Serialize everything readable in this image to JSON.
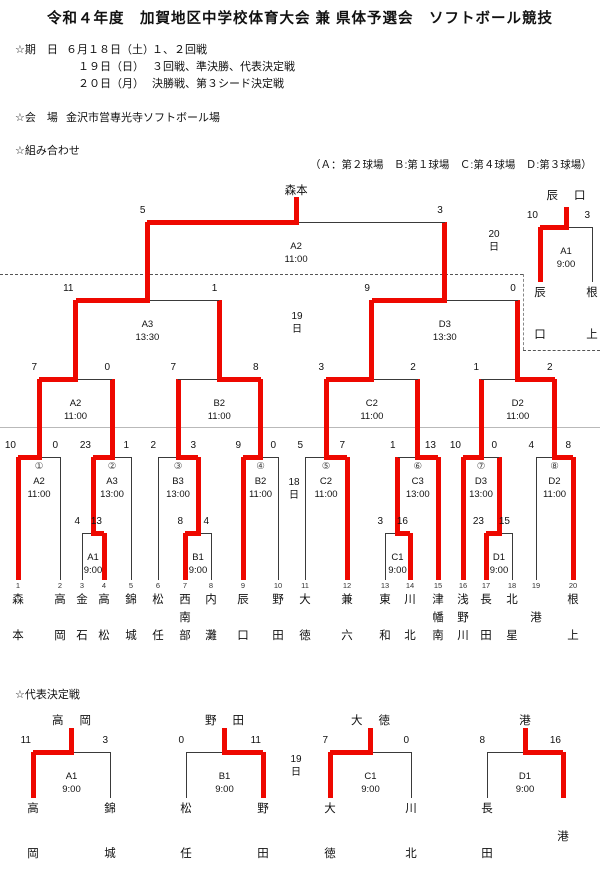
{
  "colors": {
    "winner_path": "#ee0800",
    "line": "#3a3a3a"
  },
  "header": {
    "title": "令和４年度　加賀地区中学校体育大会 兼 県体予選会　ソフトボール競技",
    "date_label": "☆期　日",
    "schedule": [
      {
        "date": "６月１８日（土）",
        "games": "１、２回戦"
      },
      {
        "date": "１９日（日）",
        "games": "３回戦、準決勝、代表決定戦"
      },
      {
        "date": "２０日（月）",
        "games": "決勝戦、第３シード決定戦"
      }
    ],
    "venue_label": "☆会　場",
    "venue": "金沢市営専光寺ソフトボール場",
    "pairings_label": "☆組み合わせ",
    "fields_note": "（Ａ：第２球場　Ｂ:第１球場　Ｃ:第４球場　Ｄ:第３球場）"
  },
  "rep_heading": "☆代表決定戦",
  "champion": "森本",
  "day_labels": [
    {
      "text": "20\n日",
      "x": 494,
      "y": 228
    },
    {
      "text": "19\n日",
      "x": 297,
      "y": 310
    },
    {
      "text": "18\n日",
      "x": 294,
      "y": 476
    },
    {
      "text": "19\n日",
      "x": 296,
      "y": 753
    }
  ],
  "teams": [
    {
      "seed": "1",
      "name": "森本",
      "x": 18
    },
    {
      "seed": "2",
      "name": "高岡",
      "x": 60
    },
    {
      "seed": "3",
      "name": "金石",
      "x": 82
    },
    {
      "seed": "4",
      "name": "高松",
      "x": 104
    },
    {
      "seed": "5",
      "name": "錦城",
      "x": 131
    },
    {
      "seed": "6",
      "name": "松任",
      "x": 158
    },
    {
      "seed": "7",
      "name": "西南部",
      "x": 185
    },
    {
      "seed": "8",
      "name": "内灘",
      "x": 211
    },
    {
      "seed": "9",
      "name": "辰口",
      "x": 243
    },
    {
      "seed": "10",
      "name": "野田",
      "x": 278
    },
    {
      "seed": "11",
      "name": "大徳",
      "x": 305
    },
    {
      "seed": "12",
      "name": "兼六",
      "x": 347
    },
    {
      "seed": "13",
      "name": "東和",
      "x": 385
    },
    {
      "seed": "14",
      "name": "川北",
      "x": 410
    },
    {
      "seed": "15",
      "name": "津幡南",
      "x": 438
    },
    {
      "seed": "16",
      "name": "浅野川",
      "x": 463
    },
    {
      "seed": "17",
      "name": "長田",
      "x": 486
    },
    {
      "seed": "18",
      "name": "北星",
      "x": 512
    },
    {
      "seed": "19",
      "name": "港",
      "x": 536
    },
    {
      "seed": "20",
      "name": "根上",
      "x": 573
    }
  ],
  "matches": [
    {
      "id": "r1-A1",
      "code": "A1",
      "time": "9:00",
      "bar_y": 533,
      "up_y": 457,
      "lx": 82,
      "rx": 104,
      "ls": "4",
      "rs": "13",
      "win": "R",
      "ld": 580,
      "rd": 580,
      "lred": false,
      "rred": true
    },
    {
      "id": "r1-B1",
      "code": "B1",
      "time": "9:00",
      "bar_y": 533,
      "up_y": 457,
      "lx": 185,
      "rx": 211,
      "ls": "8",
      "rs": "4",
      "win": "L",
      "ld": 580,
      "rd": 580,
      "lred": true,
      "rred": false
    },
    {
      "id": "r1-C1",
      "code": "C1",
      "time": "9:00",
      "bar_y": 533,
      "up_y": 457,
      "lx": 385,
      "rx": 410,
      "ls": "3",
      "rs": "16",
      "win": "R",
      "ld": 580,
      "rd": 580,
      "lred": false,
      "rred": true
    },
    {
      "id": "r1-D1",
      "code": "D1",
      "time": "9:00",
      "bar_y": 533,
      "up_y": 457,
      "lx": 486,
      "rx": 512,
      "ls": "23",
      "rs": "15",
      "win": "L",
      "ld": 580,
      "rd": 580,
      "lred": true,
      "rred": false
    },
    {
      "id": "r2-1",
      "num": "①",
      "code": "A2",
      "time": "11:00",
      "bar_y": 457,
      "up_y": 379,
      "lx": 18,
      "rx": 60,
      "ls": "10",
      "rs": "0",
      "win": "L",
      "ld": 580,
      "rd": 580,
      "lred": true,
      "rred": false
    },
    {
      "id": "r2-2",
      "num": "②",
      "code": "A3",
      "time": "13:00",
      "bar_y": 457,
      "up_y": 379,
      "lx": 93,
      "rx": 131,
      "ls": "23",
      "rs": "1",
      "win": "L",
      "rd": 580,
      "rred": false
    },
    {
      "id": "r2-3",
      "num": "③",
      "code": "B3",
      "time": "13:00",
      "bar_y": 457,
      "up_y": 379,
      "lx": 158,
      "rx": 198,
      "ls": "2",
      "rs": "3",
      "win": "R",
      "ld": 580,
      "lred": false
    },
    {
      "id": "r2-4",
      "num": "④",
      "code": "B2",
      "time": "11:00",
      "bar_y": 457,
      "up_y": 379,
      "lx": 243,
      "rx": 278,
      "ls": "9",
      "rs": "0",
      "win": "L",
      "ld": 580,
      "rd": 580,
      "lred": true,
      "rred": false
    },
    {
      "id": "r2-5",
      "num": "⑤",
      "code": "C2",
      "time": "11:00",
      "bar_y": 457,
      "up_y": 379,
      "lx": 305,
      "rx": 347,
      "ls": "5",
      "rs": "7",
      "win": "R",
      "ld": 580,
      "rd": 580,
      "lred": false,
      "rred": true
    },
    {
      "id": "r2-6",
      "num": "⑥",
      "code": "C3",
      "time": "13:00",
      "bar_y": 457,
      "up_y": 379,
      "lx": 397.5,
      "rx": 438,
      "ls": "1",
      "rs": "13",
      "win": "R",
      "rd": 580,
      "rred": true
    },
    {
      "id": "r2-7",
      "num": "⑦",
      "code": "D3",
      "time": "13:00",
      "bar_y": 457,
      "up_y": 379,
      "lx": 463,
      "rx": 499,
      "ls": "10",
      "rs": "0",
      "win": "L",
      "ld": 580,
      "lred": true
    },
    {
      "id": "r2-8",
      "num": "⑧",
      "code": "D2",
      "time": "11:00",
      "bar_y": 457,
      "up_y": 379,
      "lx": 536,
      "rx": 573,
      "ls": "4",
      "rs": "8",
      "win": "R",
      "ld": 580,
      "rd": 580,
      "lred": false,
      "rred": true
    },
    {
      "id": "qf-A2",
      "code": "A2",
      "time": "11:00",
      "bar_y": 379,
      "up_y": 300,
      "lx": 39,
      "rx": 112,
      "ls": "7",
      "rs": "0",
      "win": "L"
    },
    {
      "id": "qf-B2",
      "code": "B2",
      "time": "11:00",
      "bar_y": 379,
      "up_y": 300,
      "lx": 178,
      "rx": 260.5,
      "ls": "7",
      "rs": "8",
      "win": "R"
    },
    {
      "id": "qf-C2",
      "code": "C2",
      "time": "11:00",
      "bar_y": 379,
      "up_y": 300,
      "lx": 326,
      "rx": 417.75,
      "ls": "3",
      "rs": "2",
      "win": "L"
    },
    {
      "id": "qf-D2",
      "code": "D2",
      "time": "11:00",
      "bar_y": 379,
      "up_y": 300,
      "lx": 481,
      "rx": 554.5,
      "ls": "1",
      "rs": "2",
      "win": "R"
    },
    {
      "id": "sf-A3",
      "code": "A3",
      "time": "13:30",
      "bar_y": 300,
      "up_y": 222,
      "lx": 75.5,
      "rx": 219.25,
      "ls": "11",
      "rs": "1",
      "win": "L"
    },
    {
      "id": "sf-D3",
      "code": "D3",
      "time": "13:30",
      "bar_y": 300,
      "up_y": 222,
      "lx": 371.9,
      "rx": 517.75,
      "ls": "9",
      "rs": "0",
      "win": "L"
    },
    {
      "id": "final",
      "code": "A2",
      "time": "11:00",
      "bar_y": 222,
      "up_y": 197,
      "lx": 147.4,
      "rx": 444.8,
      "ls": "5",
      "rs": "3",
      "win": "L",
      "wn": "森本",
      "wn_spaced": false
    },
    {
      "id": "third-seed",
      "code": "A1",
      "time": "9:00",
      "bar_y": 227,
      "up_y": 207,
      "lx": 540,
      "rx": 592,
      "ls": "10",
      "rs": "3",
      "win": "L",
      "ld": 282,
      "rd": 282,
      "lred": true,
      "rred": false,
      "wn": "辰口",
      "wn_spaced": true,
      "bn": [
        {
          "t": "辰口",
          "x": 540,
          "ys": [
            284,
            326
          ]
        },
        {
          "t": "根上",
          "x": 592,
          "ys": [
            284,
            326
          ]
        }
      ]
    },
    {
      "id": "rep-A1",
      "code": "A1",
      "time": "9:00",
      "bar_y": 752,
      "up_y": 728,
      "lx": 33,
      "rx": 110,
      "ls": "11",
      "rs": "3",
      "win": "L",
      "ld": 798,
      "rd": 798,
      "lred": true,
      "rred": false,
      "wn": "高岡",
      "wn_spaced": true,
      "bn": [
        {
          "t": "高岡",
          "x": 33,
          "ys": [
            800,
            845
          ]
        },
        {
          "t": "錦城",
          "x": 110,
          "ys": [
            800,
            845
          ]
        }
      ]
    },
    {
      "id": "rep-B1",
      "code": "B1",
      "time": "9:00",
      "bar_y": 752,
      "up_y": 728,
      "lx": 186,
      "rx": 263,
      "ls": "0",
      "rs": "11",
      "win": "R",
      "ld": 798,
      "rd": 798,
      "lred": false,
      "rred": true,
      "wn": "野田",
      "wn_spaced": true,
      "bn": [
        {
          "t": "松任",
          "x": 186,
          "ys": [
            800,
            845
          ]
        },
        {
          "t": "野田",
          "x": 263,
          "ys": [
            800,
            845
          ]
        }
      ]
    },
    {
      "id": "rep-C1",
      "code": "C1",
      "time": "9:00",
      "bar_y": 752,
      "up_y": 728,
      "lx": 330,
      "rx": 411,
      "ls": "7",
      "rs": "0",
      "win": "L",
      "ld": 798,
      "rd": 798,
      "lred": true,
      "rred": false,
      "wn": "大徳",
      "wn_spaced": true,
      "bn": [
        {
          "t": "大徳",
          "x": 330,
          "ys": [
            800,
            845
          ]
        },
        {
          "t": "川北",
          "x": 411,
          "ys": [
            800,
            845
          ]
        }
      ]
    },
    {
      "id": "rep-D1",
      "code": "D1",
      "time": "9:00",
      "bar_y": 752,
      "up_y": 728,
      "lx": 487,
      "rx": 563,
      "ls": "8",
      "rs": "16",
      "win": "R",
      "ld": 798,
      "rd": 798,
      "lred": false,
      "rred": true,
      "wn": "港",
      "wn_spaced": true,
      "bn": [
        {
          "t": "長田",
          "x": 487,
          "ys": [
            800,
            845
          ]
        },
        {
          "t": "港",
          "x": 563,
          "ys": [
            828
          ]
        }
      ]
    }
  ]
}
